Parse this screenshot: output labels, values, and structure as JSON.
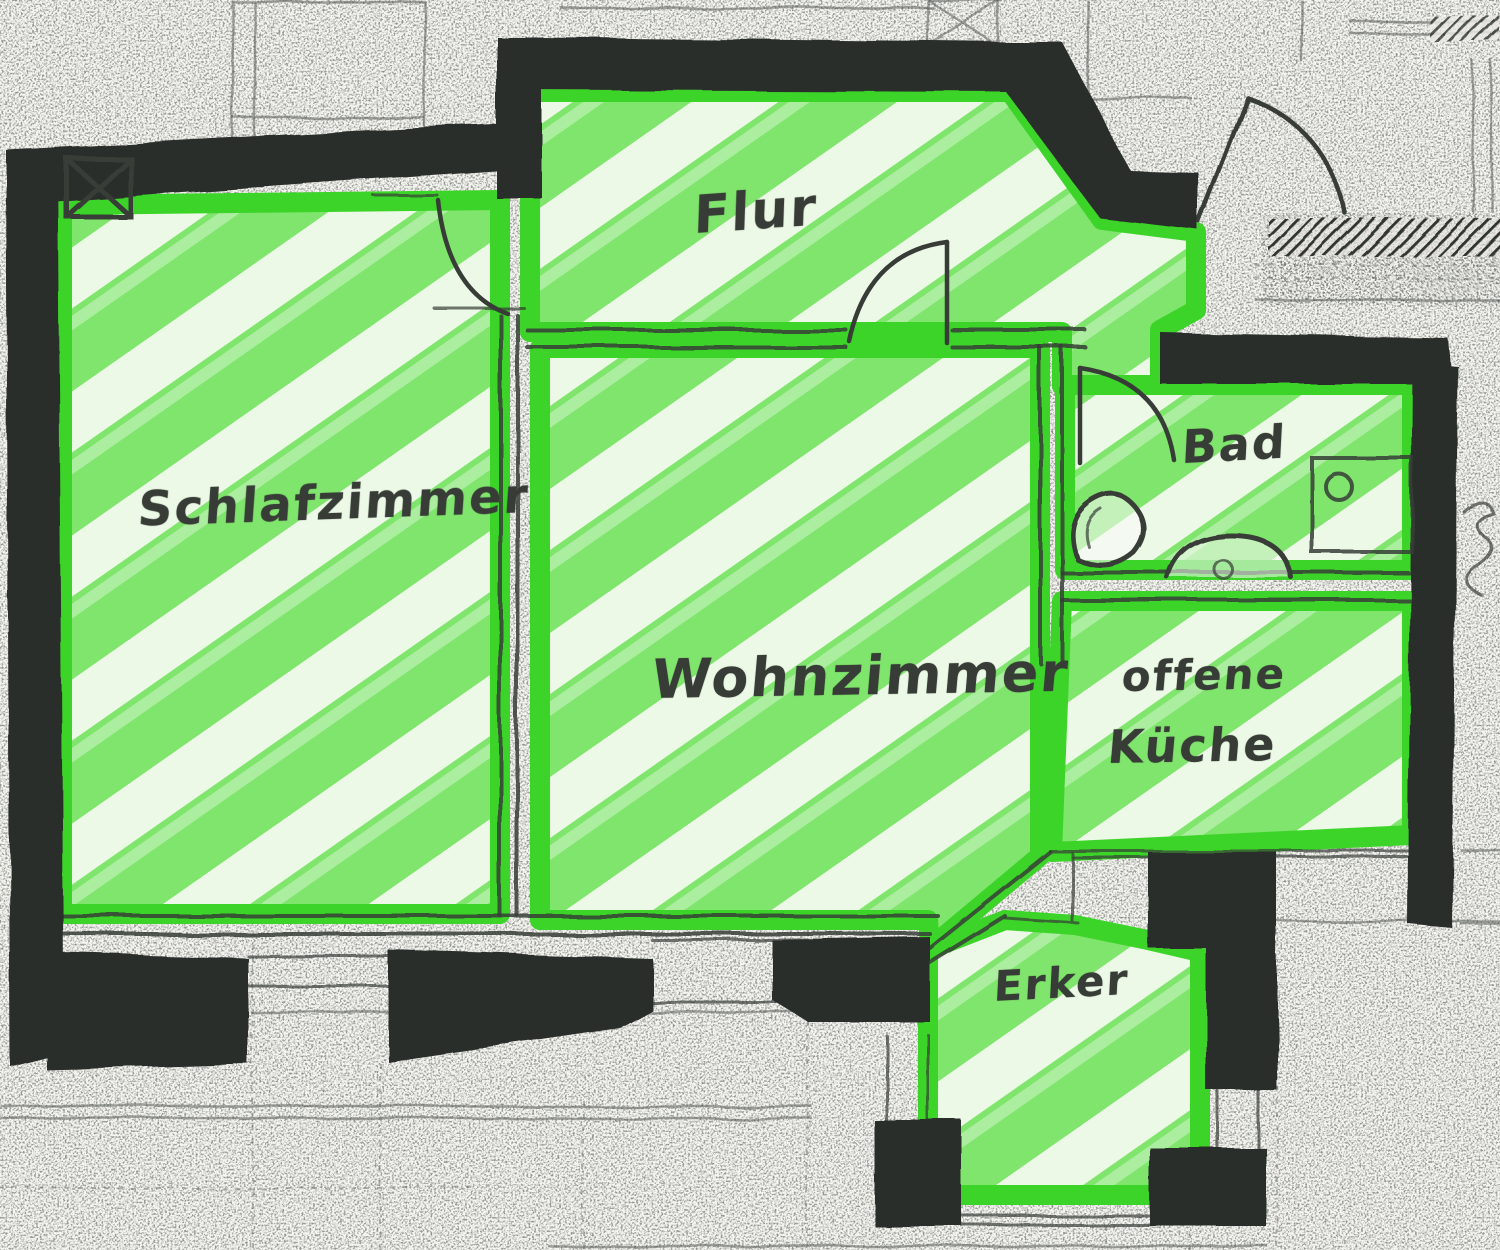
{
  "page": {
    "title": "Grundriss-Skizze",
    "language": "de",
    "kind": "hand-drawn floor plan, rooms highlighted with green marker"
  },
  "rooms": [
    {
      "id": "flur",
      "label": "Flur"
    },
    {
      "id": "schlafzimmer",
      "label": "Schlafzimmer"
    },
    {
      "id": "wohnzimmer",
      "label": "Wohnzimmer"
    },
    {
      "id": "bad",
      "label": "Bad"
    },
    {
      "id": "offene-kueche",
      "label": "offene Küche",
      "label_lines": [
        "offene",
        "Küche"
      ]
    },
    {
      "id": "erker",
      "label": "Erker"
    }
  ],
  "symbols": [
    {
      "name": "shaft-x-marker-icon"
    },
    {
      "name": "toilet-icon"
    },
    {
      "name": "washbasin-icon"
    },
    {
      "name": "shower-tray-icon"
    },
    {
      "name": "door-swing-arc"
    },
    {
      "name": "window-bar"
    },
    {
      "name": "wall-hatch"
    }
  ],
  "colors": {
    "paper": "#f5f5f1",
    "wall": "#2a2f2a",
    "green": "#80e56c",
    "greenborder": "#3dd42a",
    "ink": "#373c37",
    "bgline": "#565a58"
  }
}
